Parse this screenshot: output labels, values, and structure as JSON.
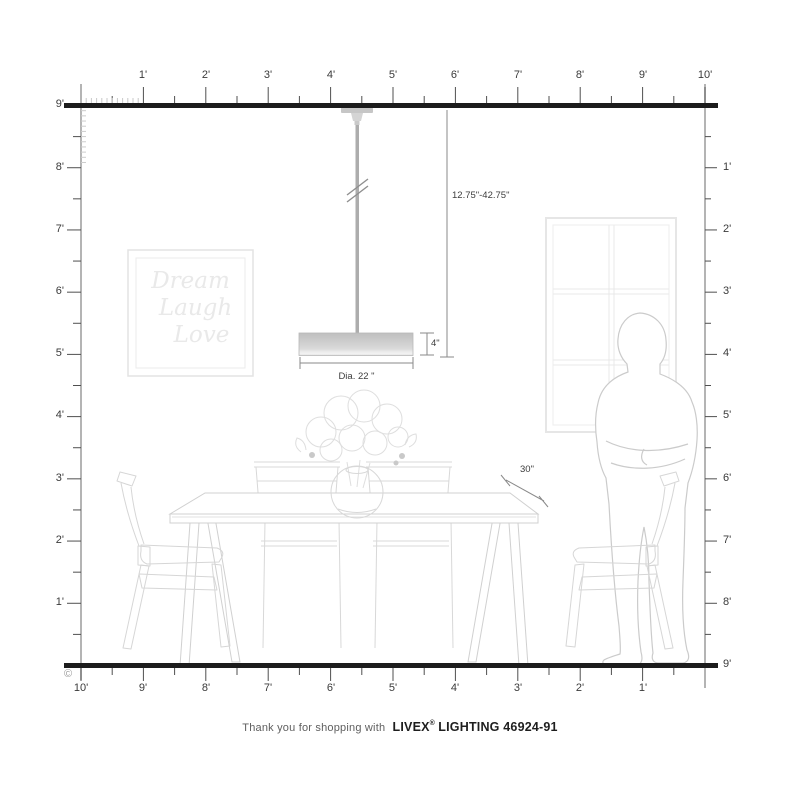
{
  "rulers": {
    "top": {
      "labels": [
        "1'",
        "2'",
        "3'",
        "4'",
        "5'",
        "6'",
        "7'",
        "8'",
        "9'",
        "10'"
      ]
    },
    "left": {
      "labels": [
        "9'",
        "8'",
        "7'",
        "6'",
        "5'",
        "4'",
        "3'",
        "2'",
        "1'"
      ]
    },
    "right": {
      "labels": [
        "1'",
        "2'",
        "3'",
        "4'",
        "5'",
        "6'",
        "7'",
        "8'",
        "9'"
      ]
    },
    "bottom": {
      "labels": [
        "10'",
        "9'",
        "8'",
        "7'",
        "6'",
        "5'",
        "4'",
        "3'",
        "2'",
        "1'"
      ]
    }
  },
  "dimensions": {
    "hang_range": "12.75\"-42.75\"",
    "shade_height": "4\"",
    "shade_diameter": "Dia. 22 \"",
    "table_height": "30\""
  },
  "wall_art": {
    "line1": "Dream",
    "line2": "Laugh",
    "line3": "Love"
  },
  "footer": {
    "prefix": "Thank you for shopping with",
    "brand": "LIVEX",
    "registered": "®",
    "suffix": "LIGHTING 46924-91"
  },
  "copyright_symbol": "©",
  "colors": {
    "structure_line": "#1c1c1c",
    "ruler_line": "#9b9b9b",
    "tick": "#4f4f4f",
    "furniture_line": "#d4d4d4",
    "dimension_line": "#8a8a8a"
  }
}
